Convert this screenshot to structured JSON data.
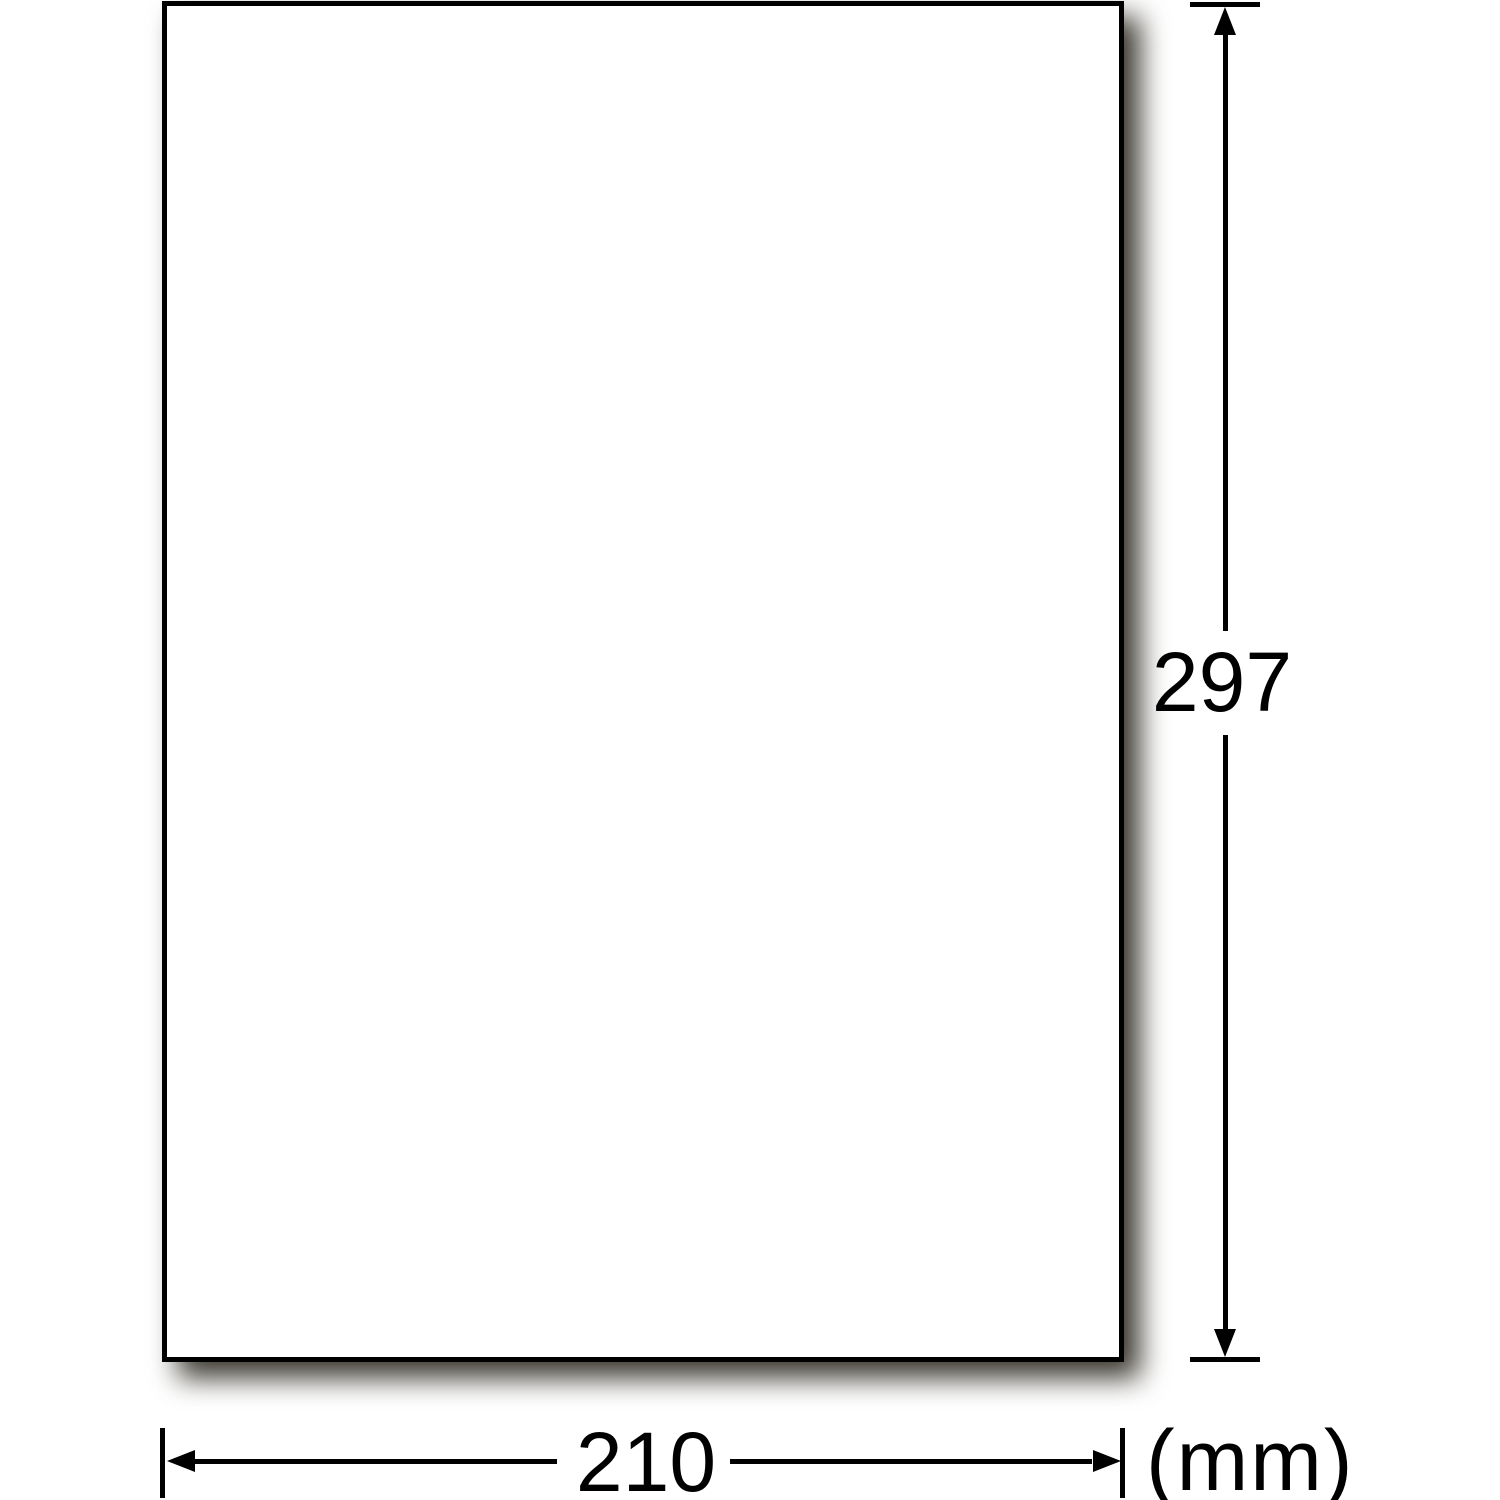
{
  "diagram": {
    "type": "paper-size-dimension-diagram",
    "sheet": {
      "shape": "rectangle",
      "fill": "white",
      "has_drop_shadow": true
    },
    "dimensions": {
      "height": {
        "value": "297",
        "orientation": "vertical",
        "side": "right"
      },
      "width": {
        "value": "210",
        "orientation": "horizontal",
        "side": "bottom"
      },
      "unit": "(mm)"
    }
  },
  "colors": {
    "stroke": "#000000",
    "paper_fill": "#ffffff",
    "shadow": "#3a372e",
    "background": "#ffffff"
  }
}
